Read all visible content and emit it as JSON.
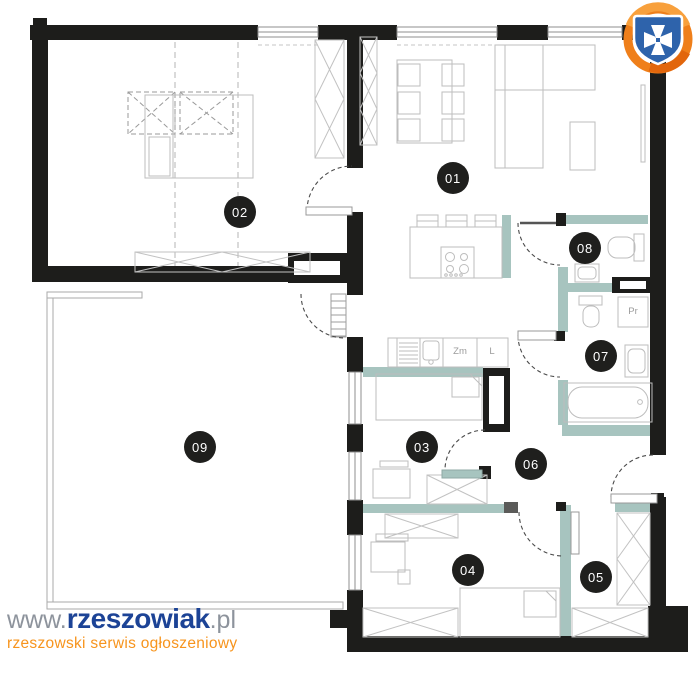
{
  "page": {
    "type": "apartment-floor-plan",
    "background": "#ffffff"
  },
  "rooms": [
    {
      "number": "01"
    },
    {
      "number": "02"
    },
    {
      "number": "03"
    },
    {
      "number": "04"
    },
    {
      "number": "05"
    },
    {
      "number": "06"
    },
    {
      "number": "07"
    },
    {
      "number": "08"
    },
    {
      "number": "09"
    }
  ],
  "appliance_labels": {
    "dishwasher": "Zm",
    "fridge": "L",
    "washing_machine": "Pr"
  },
  "watermark": {
    "url_prefix": "www.",
    "brand": "rzeszowiak",
    "url_suffix": ".pl",
    "tagline": "rzeszowski serwis ogłoszeniowy"
  },
  "logo": {
    "name": "rzeszowiak-shield-logo"
  },
  "colors": {
    "wall": "#1d1d1b",
    "partition_teal": "#a7c4bf",
    "furniture_line": "#bdbdbd",
    "badge_background": "#1f1f1d",
    "badge_text": "#ffffff",
    "brand_blue": "#1c4396",
    "brand_orange": "#f7941d",
    "brand_gray": "#8d939c"
  }
}
